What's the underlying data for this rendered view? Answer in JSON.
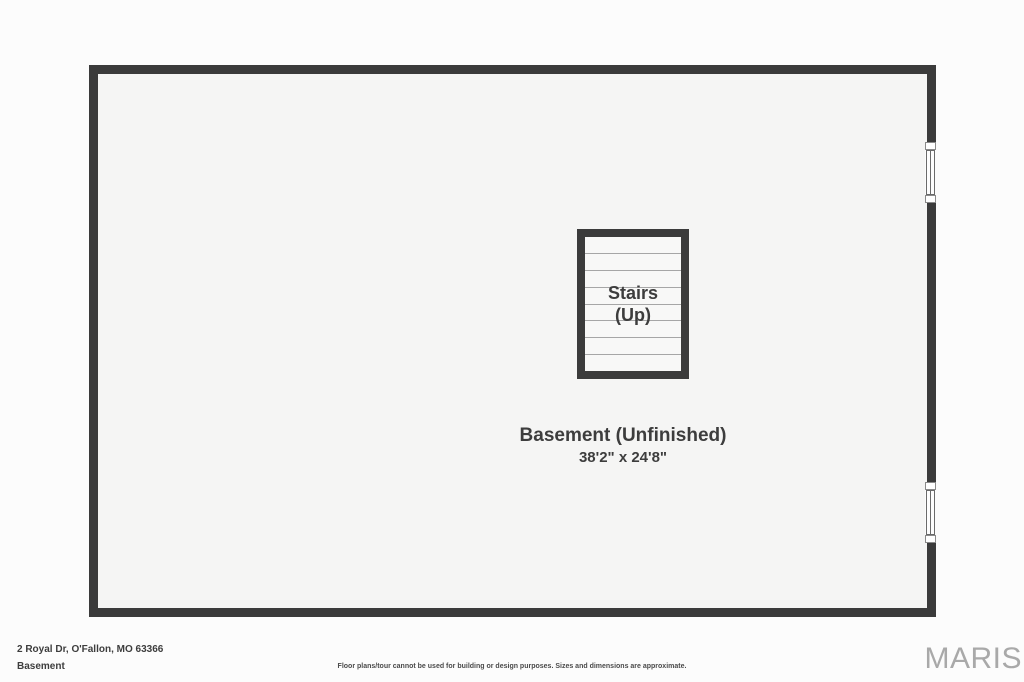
{
  "floor_plan": {
    "room": {
      "label": "Basement (Unfinished)",
      "dimensions": "38'2\" x 24'8\""
    },
    "stairs": {
      "label_line1": "Stairs",
      "label_line2": "(Up)",
      "tread_count": 8
    },
    "windows": [
      {
        "name": "right-wall-window-upper"
      },
      {
        "name": "right-wall-window-lower"
      }
    ]
  },
  "footer": {
    "address": "2 Royal Dr, O'Fallon, MO 63366",
    "floor_label": "Basement",
    "disclaimer": "Floor plans/tour cannot be used for building or design purposes. Sizes and dimensions are approximate.",
    "brand": "MARIS"
  },
  "colors": {
    "wall": "#3b3b3b",
    "text": "#3d3d3d",
    "tread_line": "#a6a6a6",
    "room_fill": "#f5f5f4",
    "page_background": "#fcfcfc",
    "brand": "#a9a9a9"
  }
}
